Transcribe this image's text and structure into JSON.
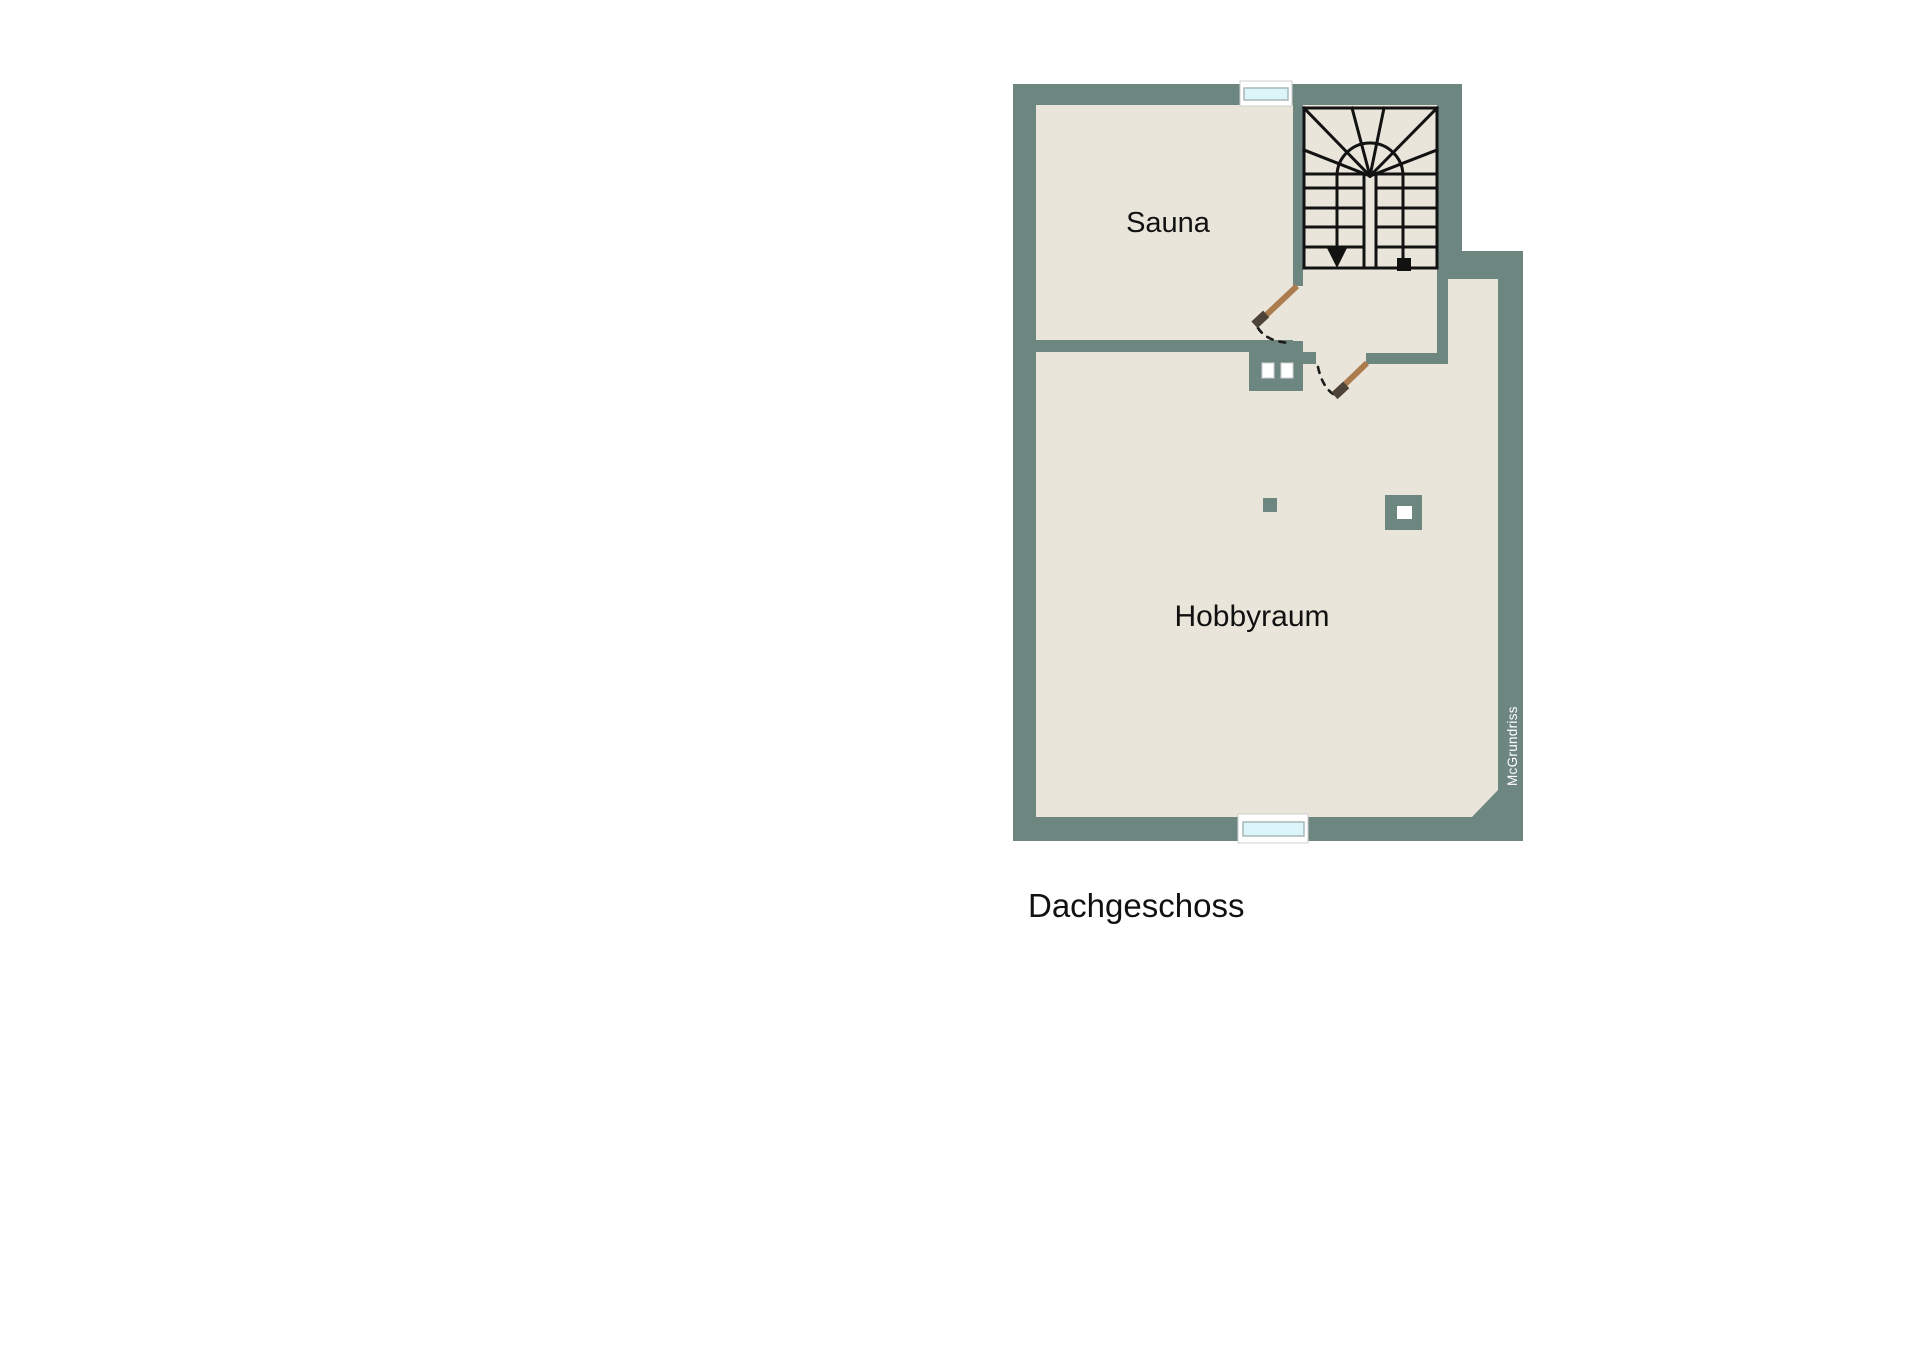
{
  "floor_plan": {
    "floor_label": "Dachgeschoss",
    "watermark": "McGrundriss",
    "rooms": [
      {
        "id": "sauna",
        "label": "Sauna"
      },
      {
        "id": "hobbyraum",
        "label": "Hobbyraum"
      }
    ],
    "features": [
      "staircase-winder",
      "stair-down-arrow",
      "stair-entry-marker",
      "sauna-door",
      "hobbyraum-door",
      "window-top",
      "window-bottom",
      "sauna-heater-block",
      "chimney-marker",
      "column-marker"
    ]
  },
  "colors": {
    "wall": "#6e8680",
    "floor": "#e9e5da",
    "door": "#ab7c4e",
    "doorcap": "#4d4336",
    "glass": "#dcf5fa",
    "line": "#121212",
    "page": "#ffffff",
    "text": "#111111",
    "watermark_text": "#ffffff"
  }
}
